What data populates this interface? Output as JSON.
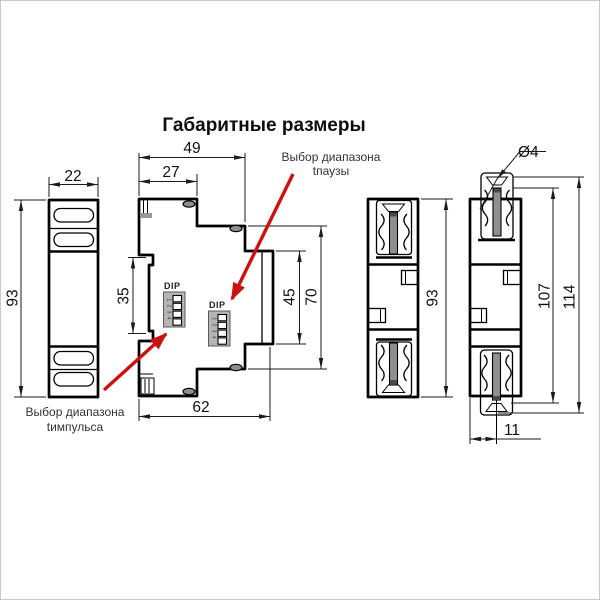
{
  "title": "Габаритные размеры",
  "colors": {
    "line": "#000000",
    "arrow": "#cc1111",
    "metal_gray": "#8f8f8f",
    "dip_body": "#b5b5b5",
    "label_text": "#333333"
  },
  "views": {
    "front": {
      "dim_width": "22",
      "dim_height": "93"
    },
    "side": {
      "dim_total_depth": "49",
      "dim_front_depth": "27",
      "dim_rail_recess": "35",
      "dim_rear_step": "45",
      "dim_body_height": "70",
      "dim_bottom_depth": "62",
      "dip1_label": "DIP",
      "dip1_numbers": "1 2 3 4",
      "dip2_label": "DIP",
      "dip2_numbers": "1 2 3 4"
    },
    "rear": {
      "dim_height": "93"
    },
    "rear_extended": {
      "dim_hole": "Ø4",
      "dim_inner_height": "107",
      "dim_total_height": "114",
      "dim_terminal_offset": "11"
    }
  },
  "annotations": {
    "pause_range": {
      "line1": "Выбор диапазона",
      "line2": "tпаузы"
    },
    "pulse_range": {
      "line1": "Выбор диапазона",
      "line2": "tимпульса"
    }
  }
}
